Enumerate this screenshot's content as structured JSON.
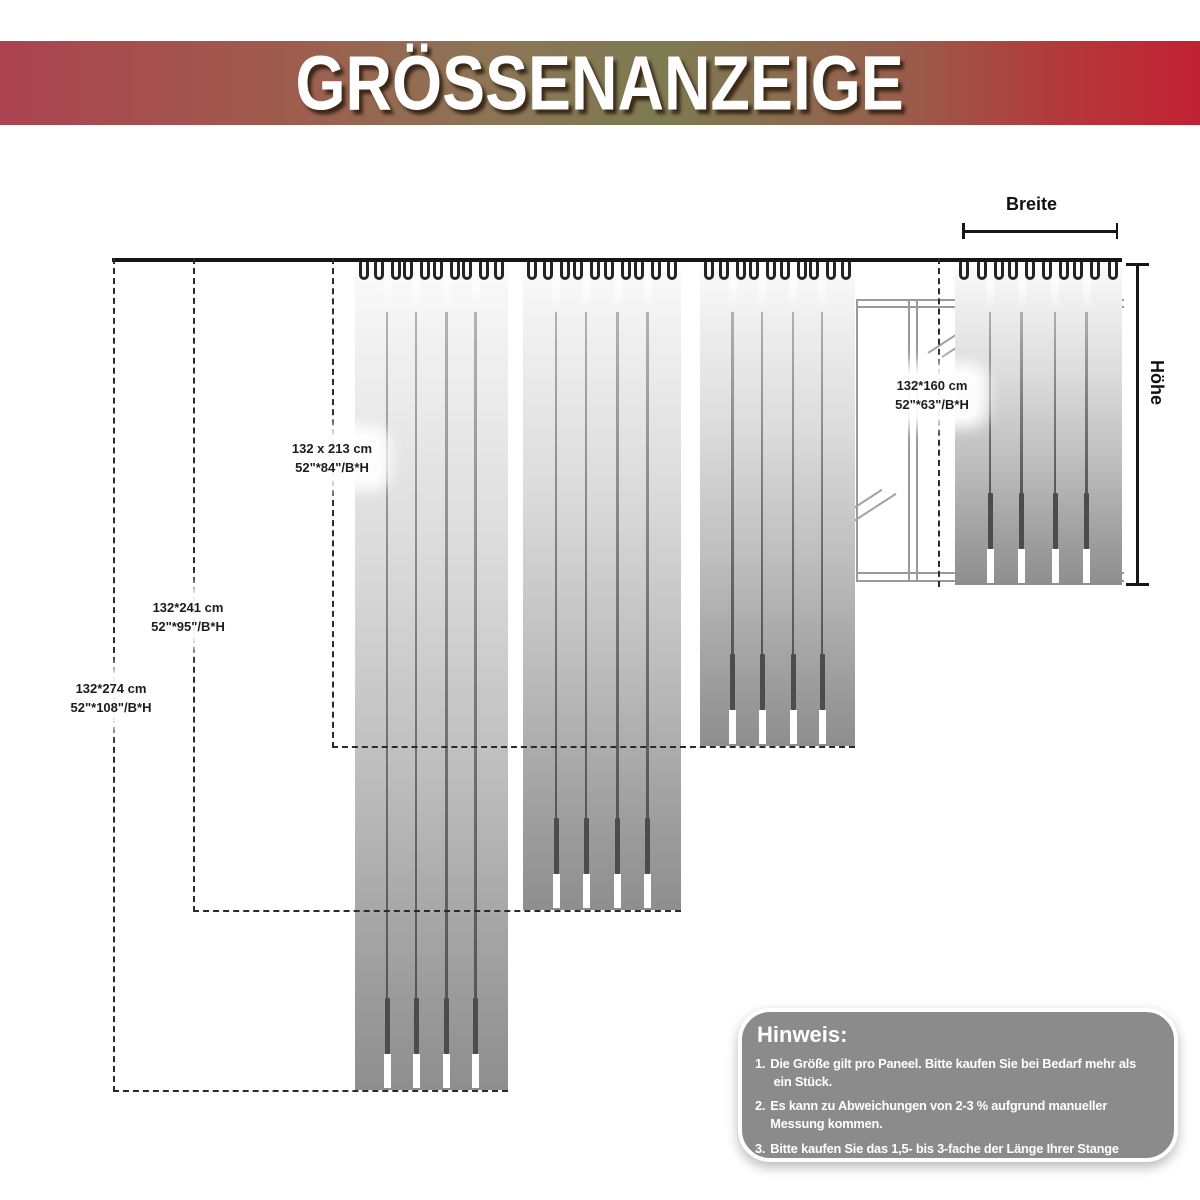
{
  "banner": {
    "title": "GRÖSSENANZEIGE"
  },
  "axes": {
    "width_label": "Breite",
    "height_label": "Höhe"
  },
  "colors": {
    "banner_left": "#ab4350",
    "banner_mid": "#7d7b52",
    "banner_right": "#c22133",
    "fabric_top": "#fbfbfb",
    "fabric_bottom": "#8e8e8e",
    "line": "#2b2b2b",
    "window_frame": "#9a9a9a",
    "note_bg": "#8b8b8b"
  },
  "sizes": [
    {
      "cm": "132*274 cm",
      "inch": "52\"*108\"/B*H",
      "panel": {
        "x": 355,
        "w": 153,
        "top": 266,
        "bottom": 1090
      },
      "guide_x": 113,
      "hline": {
        "x1": 113,
        "x2": 508
      },
      "label": {
        "x": 111,
        "y": 698
      }
    },
    {
      "cm": "132*241 cm",
      "inch": "52\"*95\"/B*H",
      "panel": {
        "x": 523,
        "w": 158,
        "top": 266,
        "bottom": 910
      },
      "guide_x": 193,
      "hline": {
        "x1": 193,
        "x2": 681
      },
      "label": {
        "x": 188,
        "y": 617
      }
    },
    {
      "cm": "132 x 213 cm",
      "inch": "52\"*84\"/B*H",
      "panel": {
        "x": 700,
        "w": 155,
        "top": 266,
        "bottom": 746
      },
      "guide_x": 332,
      "hline": {
        "x1": 332,
        "x2": 855
      },
      "label": {
        "x": 332,
        "y": 458
      }
    },
    {
      "cm": "132*160 cm",
      "inch": "52\"*63\"/B*H",
      "panel": {
        "x": 955,
        "w": 167,
        "top": 266,
        "bottom": 585
      },
      "guide_x": 938,
      "hline": null,
      "label": {
        "x": 932,
        "y": 395
      }
    }
  ],
  "note": {
    "title": "Hinweis:",
    "items": [
      {
        "num": "1.",
        "text": "Die Größe gilt pro Paneel. Bitte kaufen Sie bei Bedarf mehr als\n ein Stück."
      },
      {
        "num": "2.",
        "text": "Es kann zu Abweichungen von 2-3 % aufgrund manueller\nMessung kommen."
      },
      {
        "num": "3.",
        "text": "Bitte kaufen Sie das 1,5- bis 3-fache der Länge Ihrer Stange"
      }
    ]
  }
}
